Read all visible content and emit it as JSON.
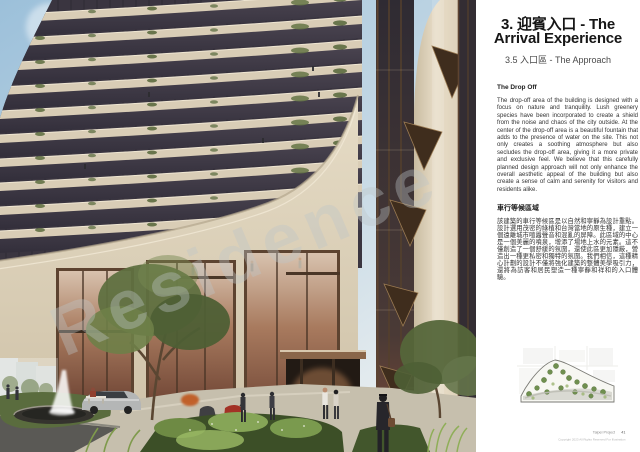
{
  "header": {
    "title_line1": "3. 迎賓入口 - The",
    "title_line2": "Arrival Experience",
    "subtitle": "3.5  入口區 - The Approach"
  },
  "drop_off": {
    "heading": "The Drop Off",
    "body": "The drop-off area of the building is designed with a focus on nature and tranquility. Lush greenery species have been incorporated to create a shield from the noise and chaos of the city outside. At the center of the drop-off area is a beautiful fountain that adds to the presence of water on the site. This not only creates a soothing atmosphere but also secludes the drop-off area, giving it a more private and exclusive feel. We believe that this carefully planned design approach will not only enhance the overall aesthetic appeal of the building but also create a sense of calm and serenity for visitors and residents alike."
  },
  "approach_zh": {
    "heading": "車行等候區域",
    "body": "該建築的車行等候區是以自然和寧靜為設計重點。設計選用茂密的綠植和台灣當地的原生種，建立一個遠離城市喧囂聲音和混亂的屏障。此區域的中心是一個美麗的噴泉，增添了場地上水的元素。這不僅創造了一個舒緩的氛圍，還使此區更加隱蔽，營造出一種更私密和獨特的氛圍。我們相信，這種精心計劃的設計不僅將強化建築的整體美學吸引力，還將為訪客和居民塑造一種寧靜和祥和的入口體驗。"
  },
  "footer": {
    "project": "Taipei Project",
    "page_number": "41",
    "copyright": "Copyright 2023 All Rights Reserved For Illustration"
  },
  "watermark": "Residence",
  "colors": {
    "facade_cream": "#d9cdb6",
    "glass_dark": "#3a3540",
    "bronze": "#5d4330",
    "interior_glow": "#c08a62",
    "greenery": "#657a42",
    "sky": "#9cc0da"
  }
}
